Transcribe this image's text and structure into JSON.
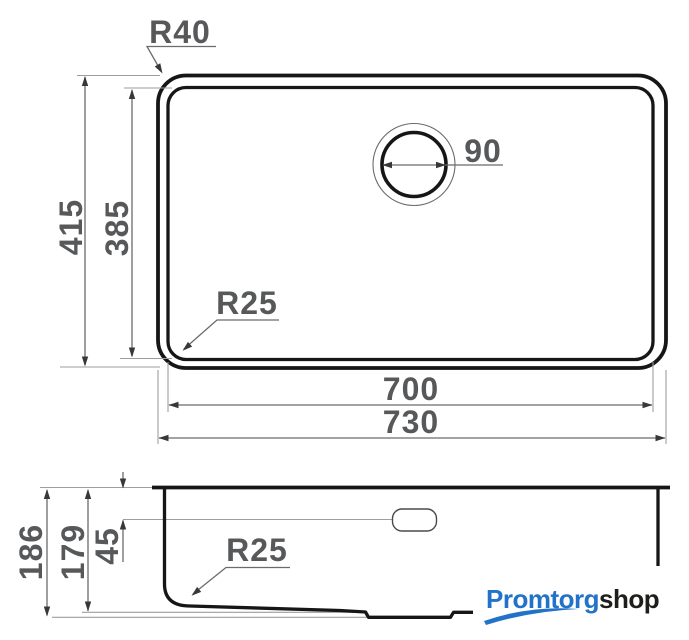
{
  "top_view": {
    "corner_radius_outer": "R40",
    "corner_radius_inner": "R25",
    "drain_diameter": "90",
    "height_outer": "415",
    "height_inner": "385",
    "width_inner": "700",
    "width_outer": "730"
  },
  "side_view": {
    "depth_total": "186",
    "depth_bowl": "179",
    "overflow_offset": "45",
    "bottom_radius": "R25"
  },
  "branding": {
    "logo_primary": "Promtorg",
    "logo_secondary": "shop",
    "logo_primary_color": "#2272c8",
    "logo_secondary_color": "#1e1e1c"
  },
  "style": {
    "outline_color": "#161616",
    "dimension_line_color": "#6b6b6b",
    "extension_line_color": "#9e9e9e",
    "text_color": "#57585a",
    "background_color": "#ffffff"
  }
}
